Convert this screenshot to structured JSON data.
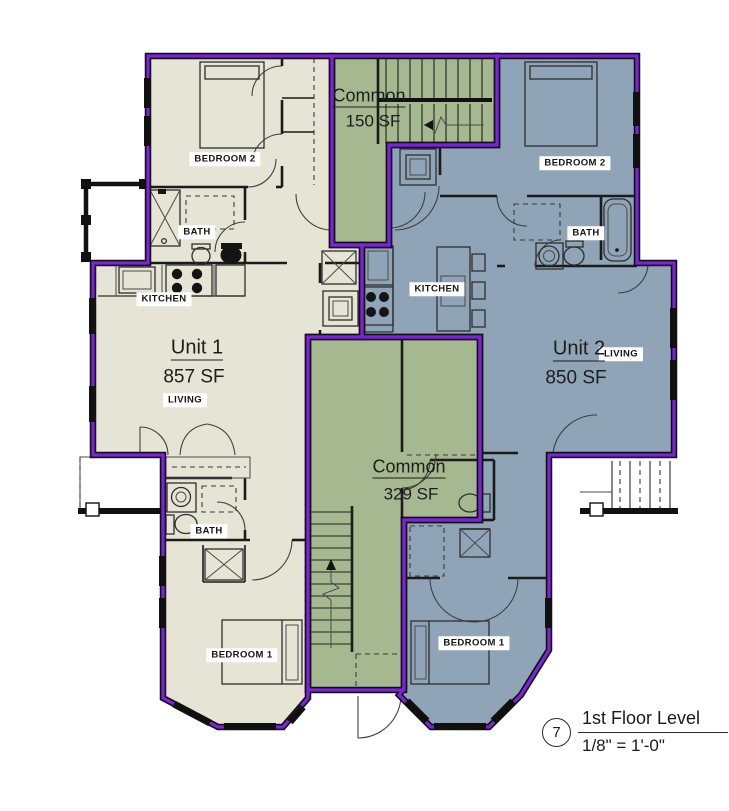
{
  "colors": {
    "unit1_fill": "#e6e4d4",
    "unit2_fill": "#8fa4b6",
    "common_fill": "#a5b88f",
    "outline_purple": "#7e22dd",
    "wall_black": "#111111"
  },
  "unit1": {
    "name": "Unit 1",
    "area": "857 SF",
    "rooms": {
      "bedroom2": "BEDROOM 2",
      "bath_upper": "BATH",
      "kitchen": "KITCHEN",
      "living": "LIVING",
      "bath_lower": "BATH",
      "bedroom1": "BEDROOM 1"
    }
  },
  "unit2": {
    "name": "Unit 2",
    "area": "850 SF",
    "rooms": {
      "bedroom2": "BEDROOM 2",
      "bath": "BATH",
      "kitchen": "KITCHEN",
      "living": "LIVING",
      "bedroom1": "BEDROOM 1"
    }
  },
  "common_upper": {
    "name": "Common",
    "area": "150 SF"
  },
  "common_lower": {
    "name": "Common",
    "area": "329 SF"
  },
  "title_block": {
    "detail_number": "7",
    "title": "1st Floor Level",
    "scale": "1/8\" = 1'-0\""
  }
}
